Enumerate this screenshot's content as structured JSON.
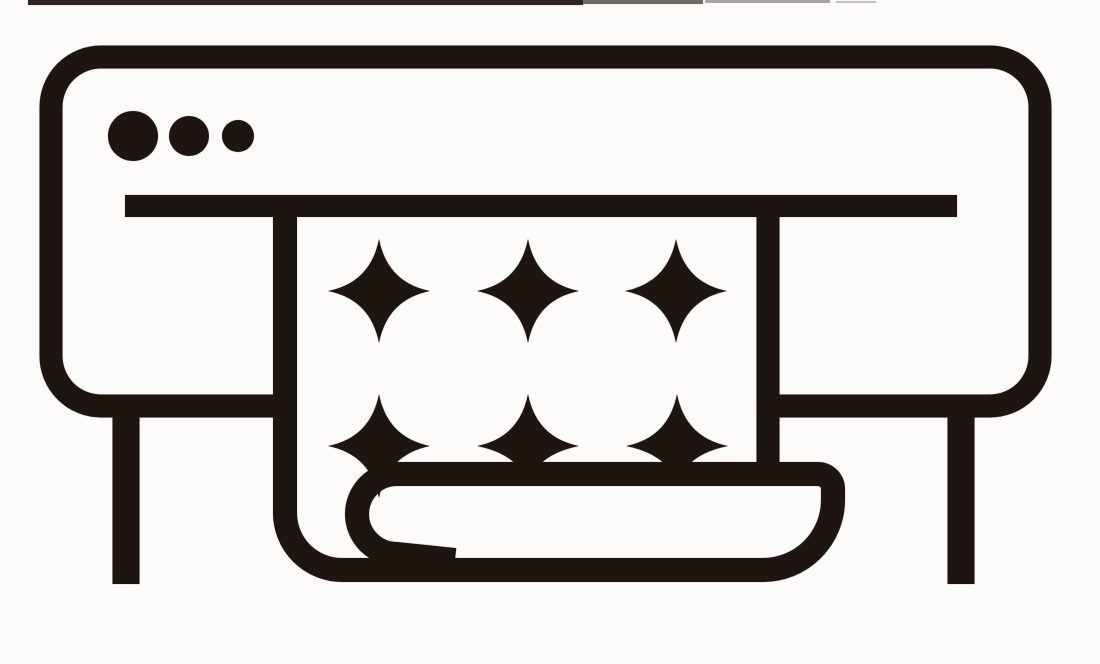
{
  "icon": {
    "subject": "wide-format-printer-printing-sparkle-sheet",
    "ink_color": "#1e1510",
    "background_color": "#fcfbfa",
    "control_dots": [
      {
        "cx": 133,
        "cy": 136,
        "r": 25
      },
      {
        "cx": 189,
        "cy": 136,
        "r": 20
      },
      {
        "cx": 238,
        "cy": 136,
        "r": 16
      }
    ],
    "sparkles": {
      "count": 6,
      "rows": 2,
      "columns": 3,
      "items": [
        {
          "x": 379,
          "y": 291,
          "variant": "full"
        },
        {
          "x": 528,
          "y": 291,
          "variant": "full"
        },
        {
          "x": 676,
          "y": 291,
          "variant": "full"
        },
        {
          "x": 379,
          "y": 446,
          "variant": "full"
        },
        {
          "x": 528,
          "y": 446,
          "variant": "cut"
        },
        {
          "x": 677,
          "y": 446,
          "variant": "cut"
        }
      ]
    },
    "artifact_marks": [
      {
        "x": 28,
        "y": 0,
        "w": 555,
        "h": 5,
        "opacity": 0.9
      },
      {
        "x": 583,
        "y": 0,
        "w": 120,
        "h": 4,
        "opacity": 0.55
      },
      {
        "x": 705,
        "y": 0,
        "w": 125,
        "h": 3,
        "opacity": 0.3
      },
      {
        "x": 836,
        "y": 1,
        "w": 40,
        "h": 2,
        "opacity": 0.2
      }
    ]
  }
}
